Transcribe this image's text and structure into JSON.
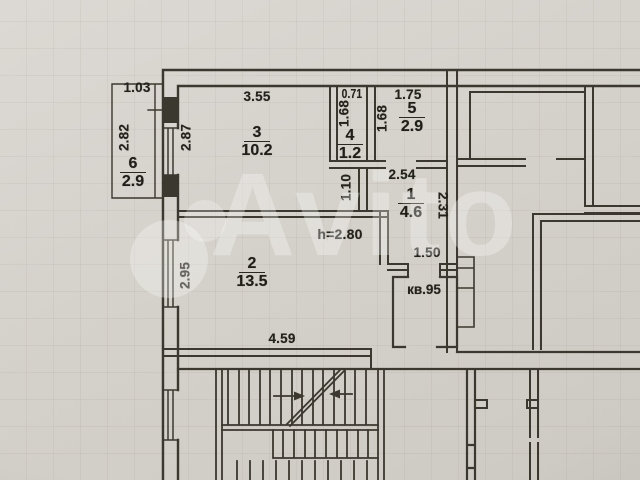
{
  "watermark": {
    "text": "Avito"
  },
  "plan": {
    "apartment_label": "кв.95",
    "ceiling_height": "h=2.80",
    "rooms": {
      "r1": {
        "number": "1",
        "area": "4.6"
      },
      "r2": {
        "number": "2",
        "area": "13.5"
      },
      "r3": {
        "number": "3",
        "area": "10.2"
      },
      "r4": {
        "number": "4",
        "area": "1.2"
      },
      "r5": {
        "number": "5",
        "area": "2.9"
      },
      "r6": {
        "number": "6",
        "area": "2.9"
      }
    },
    "dims": {
      "r6_top": "1.03",
      "r6_left": "2.82",
      "r3_top": "3.55",
      "r3_left": "2.87",
      "r4_top": "0.71",
      "r4_left": "1.68",
      "r5_top": "1.75",
      "r5_left": "1.68",
      "r1_top": "2.54",
      "r1_left": "1.10",
      "r1_right": "2.31",
      "r1_bottom": "1.50",
      "r2_left": "2.95",
      "r2_bottom": "4.59"
    }
  },
  "colors": {
    "paper": "#d5d1cb",
    "ink": "#3b382f",
    "watermark_white": "#ffffff"
  }
}
